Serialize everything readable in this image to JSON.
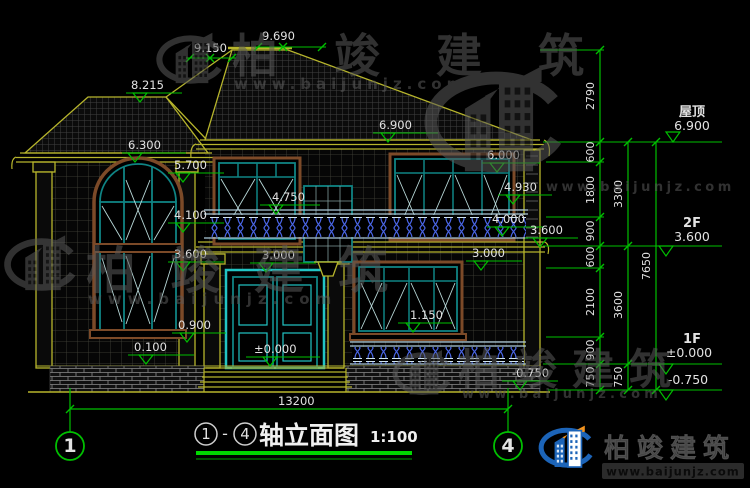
{
  "drawing": {
    "marks": {
      "v9690": "9.690",
      "v9150": "9.150",
      "v8215": "8.215",
      "v6300": "6.300",
      "v6900": "6.900",
      "v6000": "6.000",
      "v5700": "5.700",
      "v4930": "4.930",
      "v4750": "4.750",
      "v4100": "4.100",
      "v4000": "4.000",
      "v3600_left": "3.600",
      "v3600_right": "3.600",
      "v3000_door": "3.000",
      "v3000_right": "3.000",
      "v1150": "1.150",
      "v0900": "0.900",
      "v0100": "0.100",
      "v0000": "±0.000",
      "vminus0750": "-0.750",
      "total_width": "13200"
    },
    "right_dimension_chains": {
      "inner": [
        "2790",
        "600",
        "1800",
        "900",
        "600",
        "2100",
        "900",
        "750"
      ],
      "middle": [
        "3300",
        "3600",
        "750"
      ],
      "outer": [
        "7650"
      ]
    },
    "levels": [
      {
        "name": "屋顶",
        "value": "6.900"
      },
      {
        "name": "2F",
        "value": "3.600"
      },
      {
        "name": "1F",
        "value": "±0.000"
      },
      {
        "name": "",
        "value": "-0.750"
      }
    ],
    "axis_bubbles": {
      "left": "1",
      "right": "4"
    }
  },
  "title": {
    "axis_from": "1",
    "dash": "-",
    "axis_to": "4",
    "text": "轴立面图",
    "scale": "1:100"
  },
  "watermark": {
    "brand": "柏竣建筑",
    "url": "www.baijunjz.com"
  },
  "logo": {
    "brand": "柏竣建筑",
    "url": "www.baijunjz.com"
  },
  "colors": {
    "background": "#000000",
    "dimension_green": "#00bf00",
    "cad_yellow": "#b7b52c",
    "text_white": "#e2e2e2",
    "frame_teal": "#0f8484",
    "door_cyan": "#22c4c4",
    "wood_brown": "#7c4a28",
    "baluster_blue": "#4a66e8",
    "watermark_gray": "#5a5a5a",
    "logo_blue": "#1c64b8",
    "logo_orange": "#f5941d",
    "underline_green": "#00d800"
  }
}
